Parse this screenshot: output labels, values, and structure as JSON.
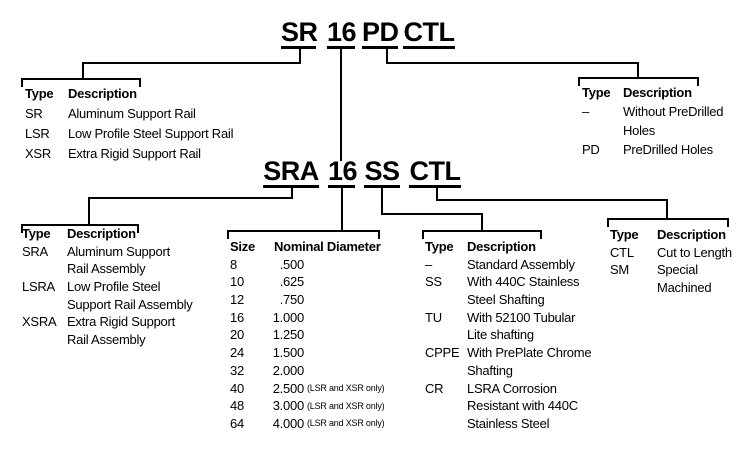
{
  "part_number_top": {
    "tokens": {
      "rail": "SR",
      "size": "16",
      "drill": "PD",
      "length": "CTL"
    }
  },
  "part_number_bottom": {
    "tokens": {
      "rail": "SRA",
      "size": "16",
      "shaft": "SS",
      "length": "CTL"
    }
  },
  "tables": {
    "rail_type": {
      "header": {
        "c1": "Type",
        "c2": "Description"
      },
      "lines": [
        {
          "c1": "SR",
          "c2": "Aluminum Support Rail"
        },
        {
          "c1": "LSR",
          "c2": "Low Profile Steel Support Rail"
        },
        {
          "c1": "XSR",
          "c2": "Extra Rigid Support Rail"
        }
      ]
    },
    "predrill": {
      "header": {
        "c1": "Type",
        "c2": "Description"
      },
      "lines": [
        {
          "c1": "–",
          "c2": "Without PreDrilled"
        },
        {
          "c1": "",
          "c2": "Holes"
        },
        {
          "c1": "PD",
          "c2": "PreDrilled Holes"
        }
      ]
    },
    "assembly_type": {
      "header": {
        "c1": "Type",
        "c2": "Description"
      },
      "lines": [
        {
          "c1": "SRA",
          "c2": "Aluminum Support"
        },
        {
          "c1": "",
          "c2": "Rail Assembly"
        },
        {
          "c1": "LSRA",
          "c2": "Low Profile Steel"
        },
        {
          "c1": "",
          "c2": "Support Rail Assembly"
        },
        {
          "c1": "XSRA",
          "c2": "Extra Rigid Support"
        },
        {
          "c1": "",
          "c2": "Rail Assembly"
        }
      ]
    },
    "size": {
      "header": {
        "c1": "Size",
        "c2": "Nominal Diameter"
      },
      "rows": [
        {
          "size": "8",
          "dia": ".500",
          "note": ""
        },
        {
          "size": "10",
          "dia": ".625",
          "note": ""
        },
        {
          "size": "12",
          "dia": ".750",
          "note": ""
        },
        {
          "size": "16",
          "dia": "1.000",
          "note": ""
        },
        {
          "size": "20",
          "dia": "1.250",
          "note": ""
        },
        {
          "size": "24",
          "dia": "1.500",
          "note": ""
        },
        {
          "size": "32",
          "dia": "2.000",
          "note": ""
        },
        {
          "size": "40",
          "dia": "2.500",
          "note": "(LSR and XSR only)"
        },
        {
          "size": "48",
          "dia": "3.000",
          "note": "(LSR and XSR only)"
        },
        {
          "size": "64",
          "dia": "4.000",
          "note": "(LSR and XSR only)"
        }
      ]
    },
    "shafting": {
      "header": {
        "c1": "Type",
        "c2": "Description"
      },
      "lines": [
        {
          "c1": "–",
          "c2": "Standard Assembly"
        },
        {
          "c1": "SS",
          "c2": "With 440C Stainless"
        },
        {
          "c1": "",
          "c2": "Steel Shafting"
        },
        {
          "c1": "TU",
          "c2": "With 52100 Tubular"
        },
        {
          "c1": "",
          "c2": "Lite shafting"
        },
        {
          "c1": "CPPE",
          "c2": "With PrePlate Chrome"
        },
        {
          "c1": "",
          "c2": "Shafting"
        },
        {
          "c1": "CR",
          "c2": "LSRA Corrosion"
        },
        {
          "c1": "",
          "c2": "Resistant with 440C"
        },
        {
          "c1": "",
          "c2": "Stainless Steel"
        }
      ]
    },
    "length": {
      "header": {
        "c1": "Type",
        "c2": "Description"
      },
      "lines": [
        {
          "c1": "CTL",
          "c2": "Cut to Length"
        },
        {
          "c1": "SM",
          "c2": "Special"
        },
        {
          "c1": "",
          "c2": "Machined"
        }
      ]
    }
  }
}
